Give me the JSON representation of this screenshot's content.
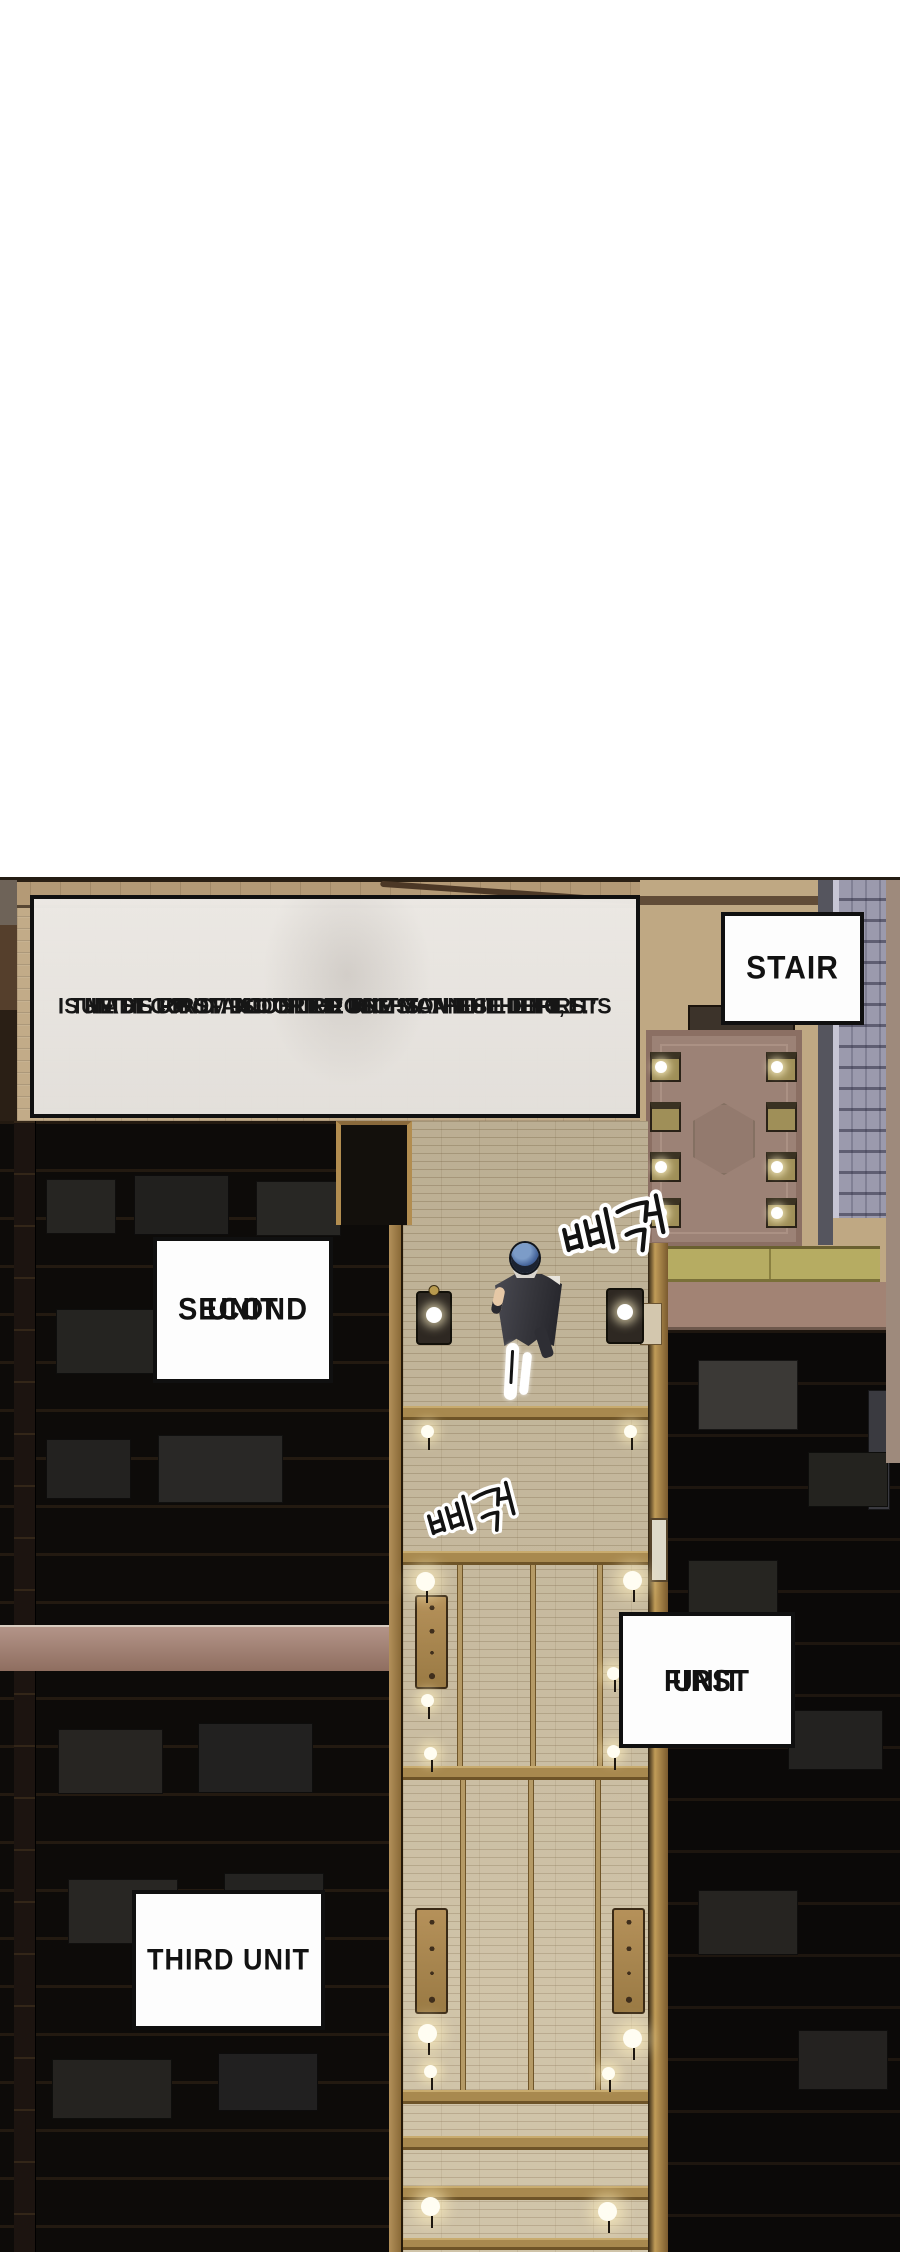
{
  "meta": {
    "image_type": "webtoon-comic-panel",
    "scene": "top-down view of inn first-floor corridor"
  },
  "caption": {
    "line1": "THE FIRST FLOOR OF THE MAN BUILDING",
    "line2": "IS MADE UP OF DOUBLE ROOMS ON THE LEFT, IT’S",
    "line3": "THE SECOND AND THIRD UNIT’S. AND THE FIRST",
    "line4": "UNIT’S ROOM IS ON THE RIGHT. THESE THREE."
  },
  "labels": {
    "stair": "STAIR",
    "second_unit_line1": "SECOND",
    "second_unit_line2": "UNIT",
    "first_unit_line1": "FIRST",
    "first_unit_line2": "UNIT",
    "third_unit": "THIRD UNIT"
  },
  "sfx": {
    "creak_1": "삐걱",
    "creak_2": "삐걱"
  },
  "colors": {
    "page_background": "#ffffff",
    "panel_dark_rooms": "#0d0b09",
    "wall_brick_tan": "#c2ab88",
    "corridor_floor": "#cbbd9f",
    "wood_beam_gold": "#a8894f",
    "rug_mauve": "#9c8276",
    "stairs_slate": "#9b9aad",
    "landing_olive_beam": "#b6ac62",
    "landing_mauve_band": "#a28374",
    "rosy_beam_left": "#a5897c",
    "character_coat": "#36363c",
    "character_hair": "#4a699a",
    "lamp_glow": "#fff3cf",
    "caption_box_bg": "#eae7e3",
    "label_box_bg": "#fdfdfd",
    "box_border": "#101010"
  }
}
